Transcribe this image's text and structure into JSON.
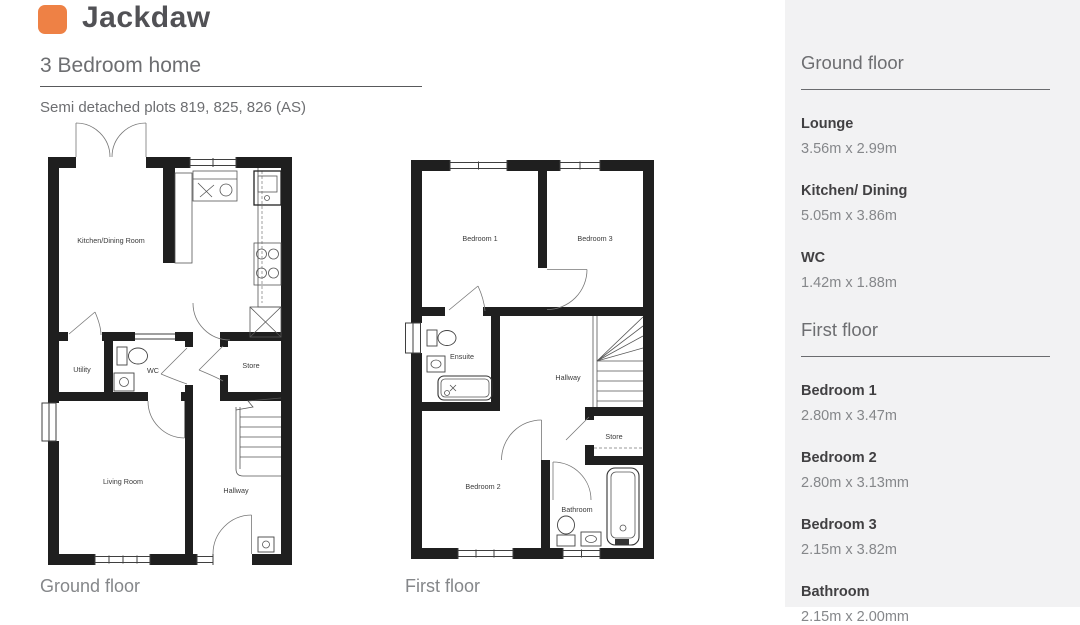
{
  "brand": {
    "name": "Jackdaw",
    "accent_color": "#ee8145"
  },
  "header": {
    "subtitle": "3 Bedroom home",
    "plots_line": "Semi detached plots 819, 825, 826 (AS)"
  },
  "plans": {
    "ground": {
      "caption": "Ground floor",
      "rooms": {
        "kitchen_dining": "Kitchen/Dining Room",
        "utility": "Utility",
        "wc": "WC",
        "store": "Store",
        "living": "Living Room",
        "hallway": "Hallway"
      }
    },
    "first": {
      "caption": "First floor",
      "rooms": {
        "bedroom1": "Bedroom 1",
        "bedroom3": "Bedroom 3",
        "ensuite": "Ensuite",
        "hallway": "Hallway",
        "bedroom2": "Bedroom 2",
        "store": "Store",
        "bathroom": "Bathroom"
      }
    }
  },
  "sidebar": {
    "sections": [
      {
        "title": "Ground floor",
        "rooms": [
          {
            "name": "Lounge",
            "dims": "3.56m x 2.99m"
          },
          {
            "name": "Kitchen/ Dining",
            "dims": "5.05m x 3.86m"
          },
          {
            "name": "WC",
            "dims": "1.42m x 1.88m"
          }
        ]
      },
      {
        "title": "First floor",
        "rooms": [
          {
            "name": "Bedroom 1",
            "dims": "2.80m x  3.47m"
          },
          {
            "name": "Bedroom 2",
            "dims": "2.80m x 3.13mm"
          },
          {
            "name": "Bedroom 3",
            "dims": "2.15m x 3.82m"
          },
          {
            "name": "Bathroom",
            "dims": "2.15m x 2.00mm"
          }
        ]
      }
    ]
  }
}
